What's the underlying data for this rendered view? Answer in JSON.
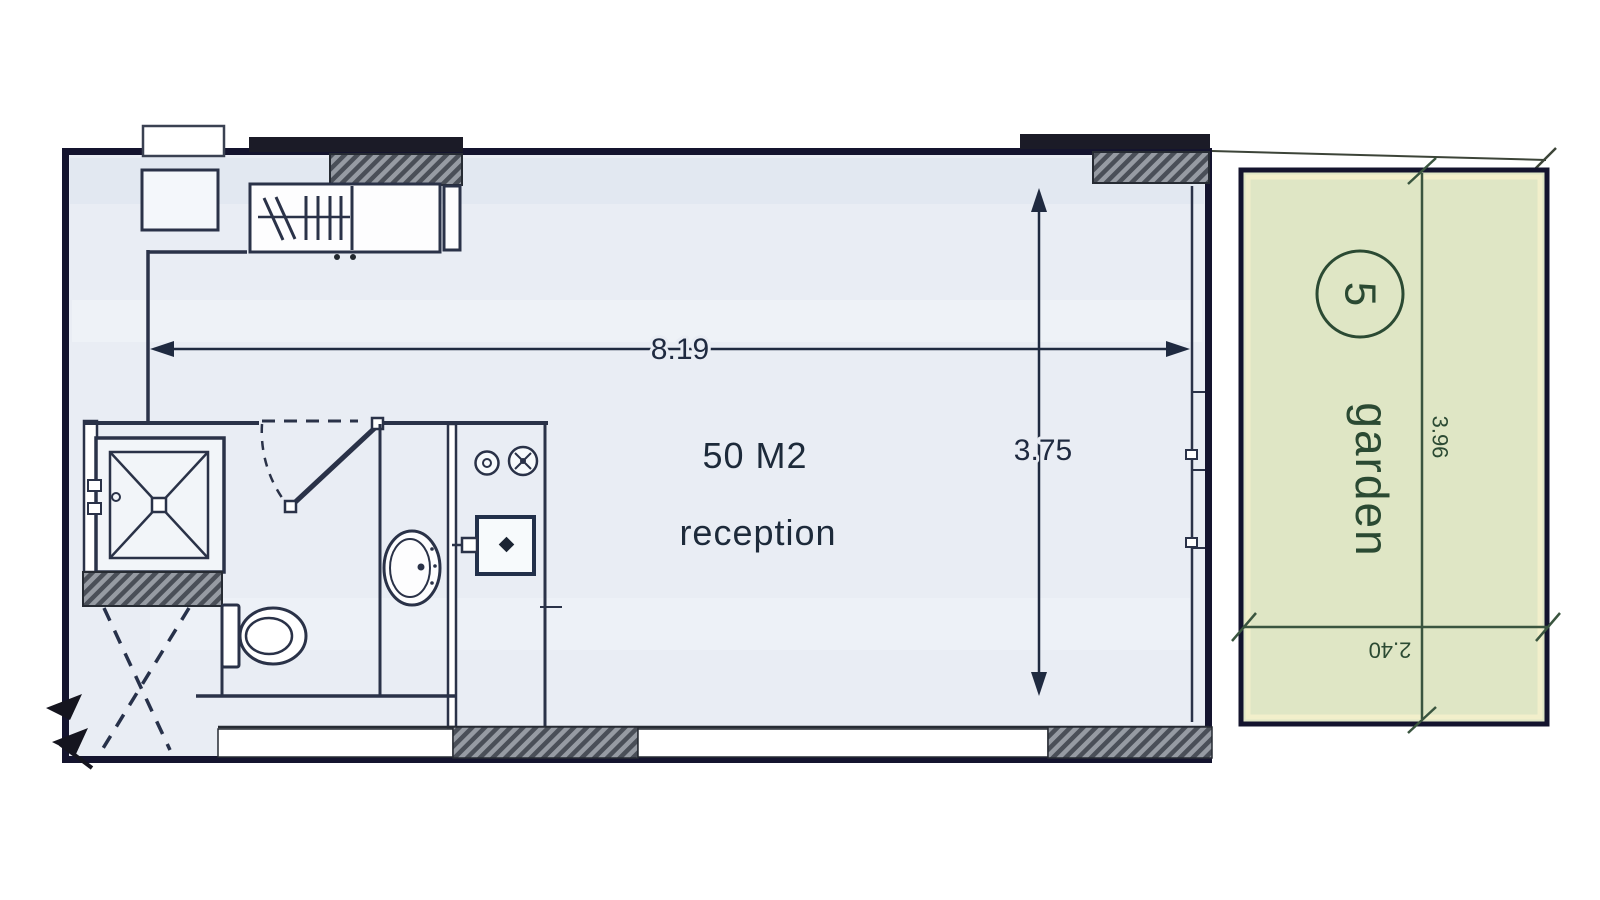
{
  "plan": {
    "width_dim": "8.19",
    "height_dim": "3.75",
    "area_label": "50 M2",
    "room_name": "reception"
  },
  "garden": {
    "label": "garden",
    "unit_number": "5",
    "length_dim": "3.96",
    "width_dim": "2.40"
  },
  "colors": {
    "paper": "#ffffff",
    "floor": "#e9edf4",
    "wall": "#14142e",
    "ink": "#2a3248",
    "dim_ink": "#1f2a40",
    "garden_fill": "#dfe6c5",
    "garden_edge": "#f2efcb",
    "garden_ink": "#2b4a33",
    "hatch_dark": "#4a4f58",
    "hatch_light": "#969ba3",
    "lintel_bar": "#1b1b27"
  }
}
